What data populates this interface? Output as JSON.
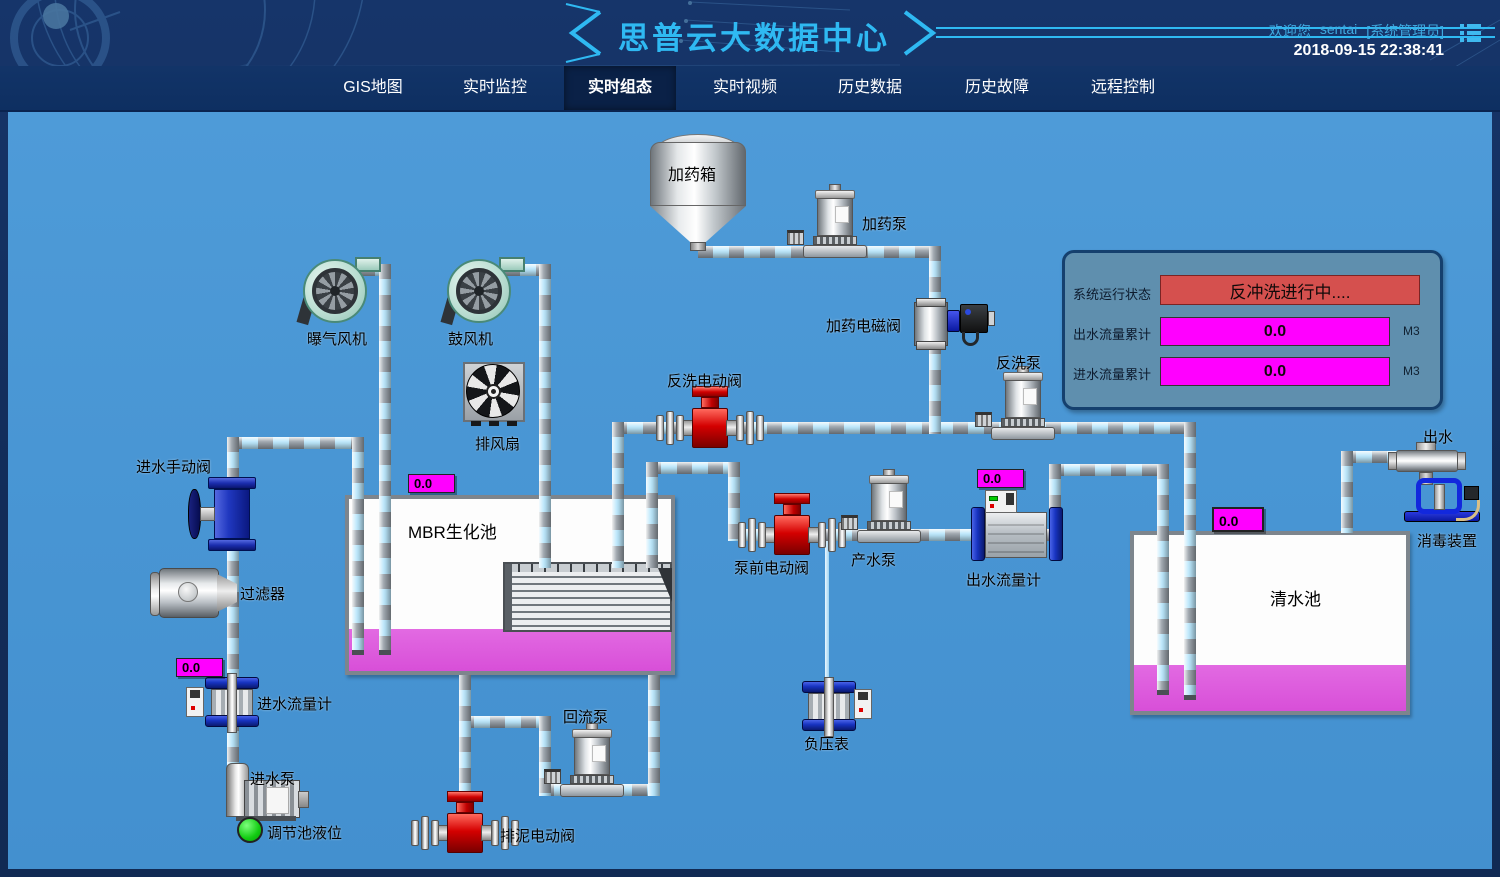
{
  "header": {
    "title": "思普云大数据中心",
    "welcome_prefix": "欢迎您",
    "username": "sentai",
    "role": "[系统管理员]",
    "datetime": "2018-09-15 22:38:41"
  },
  "nav": {
    "tabs": [
      {
        "label": "GIS地图",
        "active": false
      },
      {
        "label": "实时监控",
        "active": false
      },
      {
        "label": "实时组态",
        "active": true
      },
      {
        "label": "实时视频",
        "active": false
      },
      {
        "label": "历史数据",
        "active": false
      },
      {
        "label": "历史故障",
        "active": false
      },
      {
        "label": "远程控制",
        "active": false
      }
    ]
  },
  "status_panel": {
    "system_status_label": "系统运行状态",
    "system_status_value": "反冲洗进行中....",
    "outlet_total_label": "出水流量累计",
    "outlet_total_value": "0.0",
    "outlet_total_unit": "M3",
    "inlet_total_label": "进水流量累计",
    "inlet_total_value": "0.0",
    "inlet_total_unit": "M3"
  },
  "displays": {
    "mbr_value": "0.0",
    "inlet_value": "0.0",
    "outlet_value": "0.0",
    "clean_tank_value": "0.0"
  },
  "labels": {
    "aeration_blower": "曝气风机",
    "blower": "鼓风机",
    "exhaust_fan": "排风扇",
    "dosing_tank": "加药箱",
    "dosing_pump": "加药泵",
    "dosing_solenoid_valve": "加药电磁阀",
    "backwash_valve": "反洗电动阀",
    "backwash_pump": "反洗泵",
    "inlet_manual_valve": "进水手动阀",
    "filter": "过滤器",
    "mbr_tank": "MBR生化池",
    "inlet_flow_meter": "进水流量计",
    "inlet_pump": "进水泵",
    "regulating_tank_level": "调节池液位",
    "sludge_valve": "排泥电动阀",
    "reflux_pump": "回流泵",
    "prepump_valve": "泵前电动阀",
    "product_pump": "产水泵",
    "outlet_flow_meter": "出水流量计",
    "vacuum_gauge": "负压表",
    "clean_tank": "清水池",
    "outlet": "出水",
    "disinfection": "消毒装置"
  },
  "colors": {
    "accent_cyan": "#2fb9f2",
    "diagram_bg": "#4795d3",
    "alarm_red": "#d5504e",
    "readout_magenta": "#ff00ff",
    "liquid_magenta": "#d84fd8",
    "level_green": "#12cc12"
  }
}
